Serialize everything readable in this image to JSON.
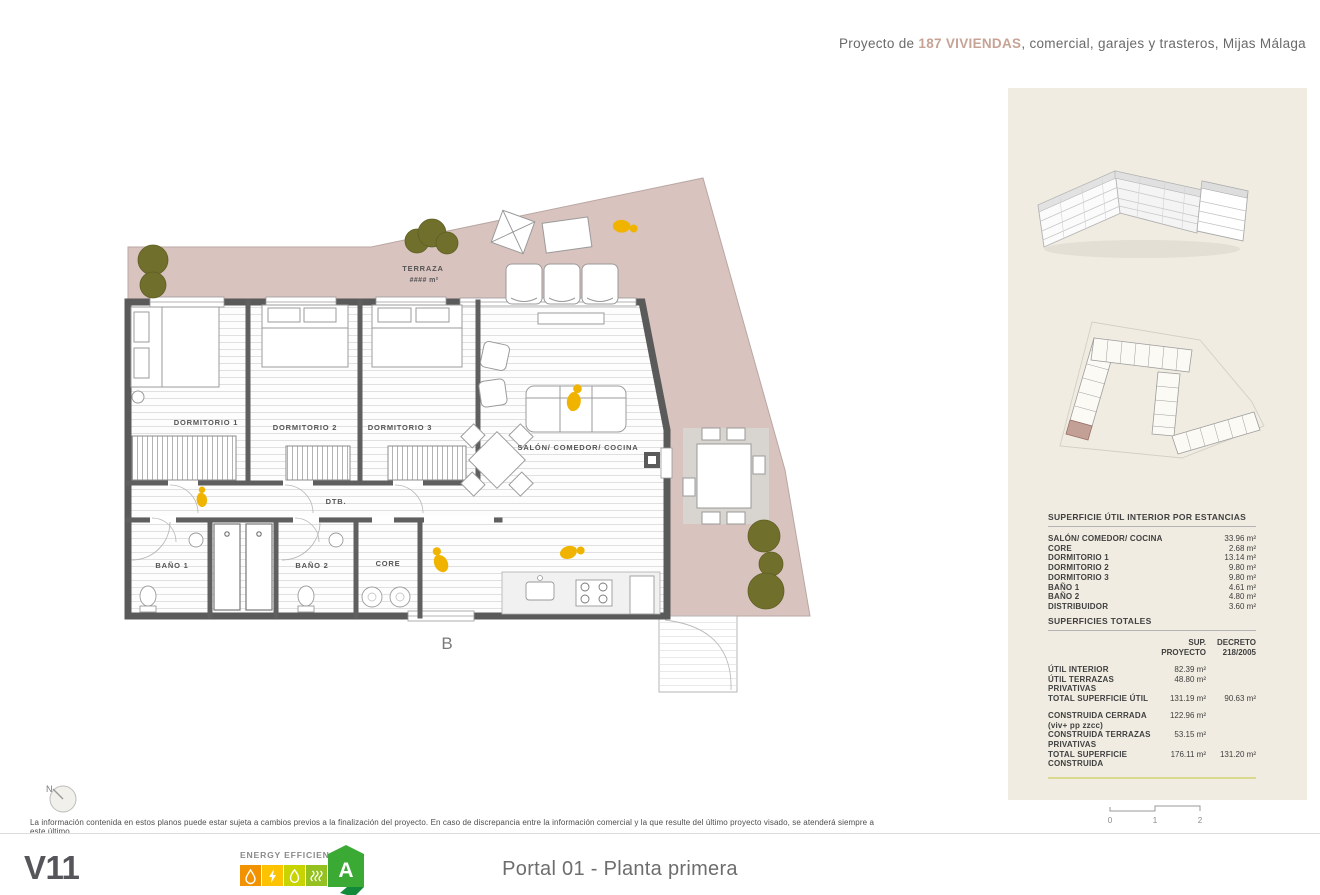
{
  "header": {
    "prefix": "Proyecto de ",
    "highlight": "187 VIVIENDAS",
    "suffix": ", comercial, garajes y trasteros, Mijas Málaga"
  },
  "plan": {
    "terraza_label": "TERRAZA",
    "terraza_area": "#### m²",
    "dormitorio1": "DORMITORIO 1",
    "dormitorio2": "DORMITORIO 2",
    "dormitorio3": "DORMITORIO 3",
    "salon": "SALÓN/ COMEDOR/ COCINA",
    "bano1": "BAÑO 1",
    "bano2": "BAÑO 2",
    "core": "CORE",
    "dtb": "DTB.",
    "section_label": "B",
    "compass_label": "N"
  },
  "sidebar": {
    "surface_table": {
      "title": "SUPERFICIE ÚTIL INTERIOR POR ESTANCIAS",
      "rows": [
        {
          "label": "SALÓN/ COMEDOR/ COCINA",
          "value": "33.96 m²"
        },
        {
          "label": "CORE",
          "value": "2.68 m²"
        },
        {
          "label": "DORMITORIO 1",
          "value": "13.14 m²"
        },
        {
          "label": "DORMITORIO 2",
          "value": "9.80 m²"
        },
        {
          "label": "DORMITORIO 3",
          "value": "9.80 m²"
        },
        {
          "label": "BAÑO 1",
          "value": "4.61 m²"
        },
        {
          "label": "BAÑO 2",
          "value": "4.80 m²"
        },
        {
          "label": "DISTRIBUIDOR",
          "value": "3.60 m²"
        }
      ]
    },
    "totals_table": {
      "title": "SUPERFICIES TOTALES",
      "col_proyecto_line1": "SUP.",
      "col_proyecto_line2": "PROYECTO",
      "col_decreto_line1": "DECRETO",
      "col_decreto_line2": "218/2005",
      "rows": [
        {
          "label": "ÚTIL INTERIOR",
          "proyecto": "82.39 m²",
          "decreto": ""
        },
        {
          "label": "ÚTIL TERRAZAS PRIVATIVAS",
          "proyecto": "48.80 m²",
          "decreto": ""
        },
        {
          "label": "TOTAL SUPERFICIE ÚTIL",
          "proyecto": "131.19 m²",
          "decreto": "90.63 m²"
        },
        {
          "label": "CONSTRUIDA CERRADA (viv+ pp zzcc)",
          "proyecto": "122.96 m²",
          "decreto": ""
        },
        {
          "label": "CONSTRUIDA TERRAZAS PRIVATIVAS",
          "proyecto": "53.15 m²",
          "decreto": ""
        },
        {
          "label": "TOTAL SUPERFICIE CONSTRUIDA",
          "proyecto": "176.11 m²",
          "decreto": "131.20 m²"
        }
      ]
    },
    "scale_marks": [
      "0",
      "1",
      "2"
    ]
  },
  "footer": {
    "logo": "V11",
    "disclaimer": "La información contenida en estos planos puede estar sujeta a cambios previos a la finalización del proyecto. En caso de discrepancia entre la información comercial y la que resulte del último proyecto visado, se atenderá siempre a este último.",
    "energy_label": "ENERGY EFFICIENCY",
    "energy_rating": "A",
    "sheet_title": "Portal 01 - Planta primera"
  },
  "colors": {
    "accent": "#c7a395",
    "terrace": "#d9c3bf",
    "panel": "#f0ece1",
    "wall": "#5a5a5a",
    "person": "#f0b400",
    "tree": "#70702c",
    "energy_orange": "#f39200",
    "energy_yellow": "#fdc300",
    "energy_lime": "#c8d400",
    "energy_green": "#94c11f",
    "energy_badge": "#3aaa35"
  }
}
